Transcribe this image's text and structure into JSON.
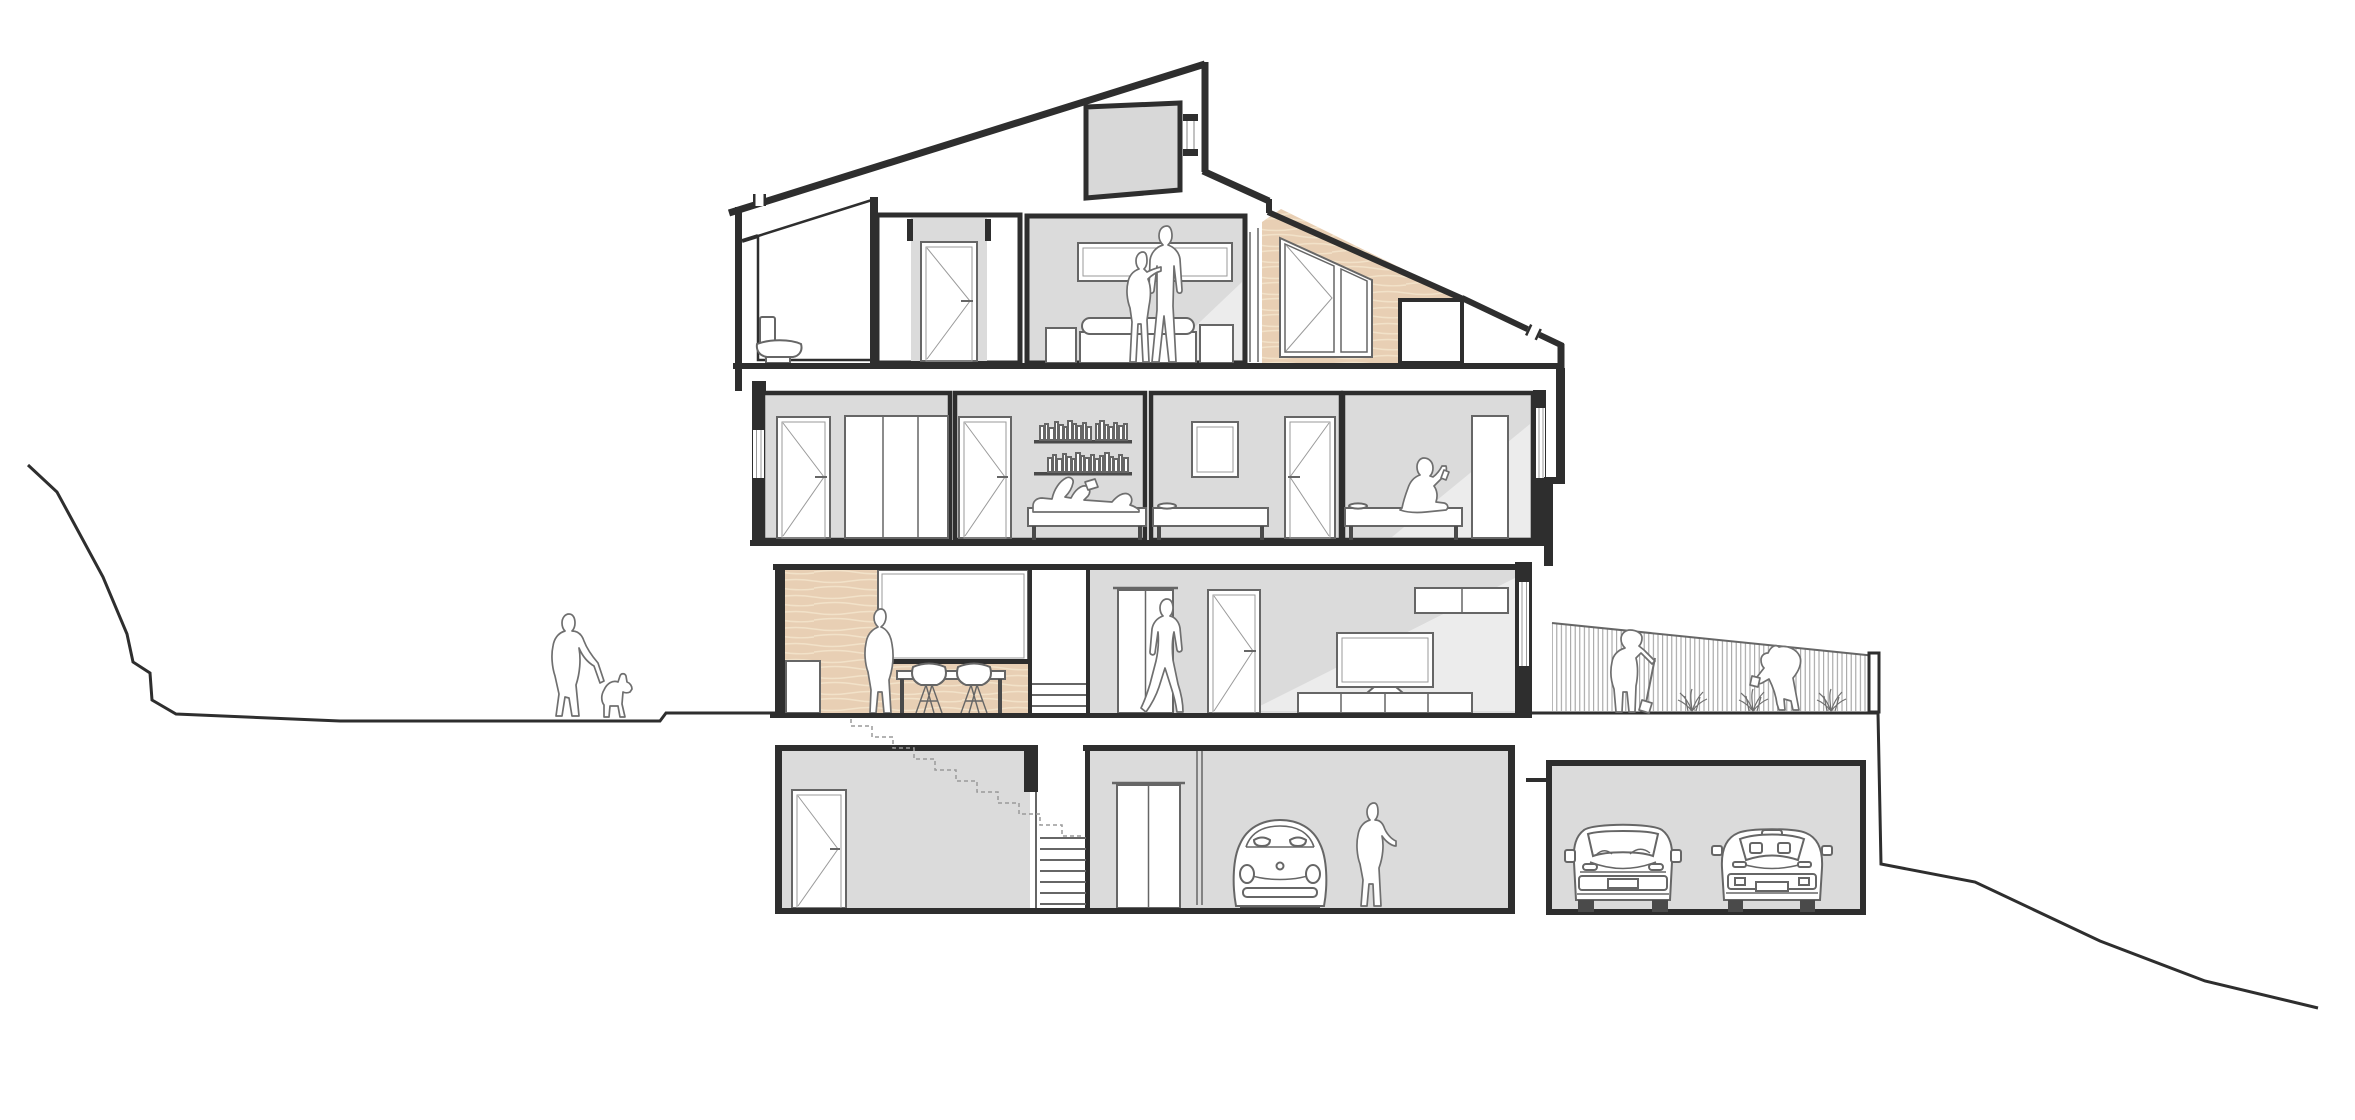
{
  "palette": {
    "paper": "#ffffff",
    "ink": "#2e2e2e",
    "line_mid": "#666666",
    "line_soft": "#9a9a9a",
    "room_gray": "#dbdbdb",
    "room_light": "#ececec",
    "dormer_gray": "#d8d8d8",
    "wood": "#e8cfb4",
    "wood_grain": "#f2e2c9",
    "tile_line": "#b3b3b3",
    "figure_outline": "#6f6f6f",
    "wheel_dark": "#4a4a4a"
  },
  "drawing": {
    "type": "architectural-section",
    "floors": [
      {
        "name": "attic",
        "rooms": [
          {
            "name": "bathroom",
            "items": [
              "tiled-wall",
              "toilet"
            ]
          },
          {
            "name": "hallway",
            "items": [
              "door"
            ]
          },
          {
            "name": "bedroom",
            "items": [
              "window",
              "double-bed",
              "nightstand-left",
              "nightstand-right",
              "standing-couple"
            ]
          },
          {
            "name": "loggia",
            "items": [
              "sloped-wood-wall",
              "tilt-window"
            ]
          }
        ]
      },
      {
        "name": "second-floor",
        "rooms": [
          {
            "name": "bedroom-1",
            "items": [
              "door",
              "wardrobe",
              "facade-window-left"
            ]
          },
          {
            "name": "bedroom-2",
            "items": [
              "door",
              "bookshelf-upper",
              "bookshelf-lower",
              "bed",
              "person-lying-reading"
            ]
          },
          {
            "name": "bedroom-3",
            "items": [
              "picture-frame",
              "bed",
              "dish",
              "door"
            ]
          },
          {
            "name": "bedroom-4",
            "items": [
              "bed",
              "dish",
              "person-sitting-with-phone",
              "wardrobe",
              "facade-window-right"
            ]
          }
        ]
      },
      {
        "name": "ground-floor",
        "rooms": [
          {
            "name": "kitchen-dining",
            "items": [
              "wood-wall",
              "window",
              "counter",
              "dining-table",
              "chair",
              "chair",
              "standing-woman"
            ]
          },
          {
            "name": "staircase",
            "items": [
              "steps",
              "dashed-stair-outline"
            ]
          },
          {
            "name": "hallway-living",
            "items": [
              "elevator-doors",
              "walking-man",
              "door",
              "wall-cabinets",
              "tv",
              "tv-cabinet",
              "facade-window-right"
            ]
          }
        ]
      },
      {
        "name": "basement",
        "rooms": [
          {
            "name": "storage-room",
            "items": [
              "door"
            ]
          },
          {
            "name": "staircase",
            "items": [
              "steps"
            ]
          },
          {
            "name": "hall",
            "items": [
              "elevator-doors",
              "glass-partition"
            ]
          },
          {
            "name": "garage",
            "items": [
              "beetle-car",
              "standing-woman"
            ]
          }
        ]
      }
    ],
    "roof": [
      "mono-pitched-roof",
      "roof-notch-left",
      "rooftop-dormer",
      "dormer-window",
      "ridge",
      "chimney-notch"
    ],
    "outside_left": [
      "hill-terrain",
      "ground-line",
      "woman-walking-dog",
      "dog"
    ],
    "outside_right": [
      "garden-ground",
      "slatted-fence",
      "fence-post",
      "gardener-digging",
      "spade",
      "gardener-bending",
      "plants",
      "retaining-wall",
      "sloping-terrain"
    ],
    "detached_garage": [
      "suv-car",
      "sports-car"
    ]
  }
}
